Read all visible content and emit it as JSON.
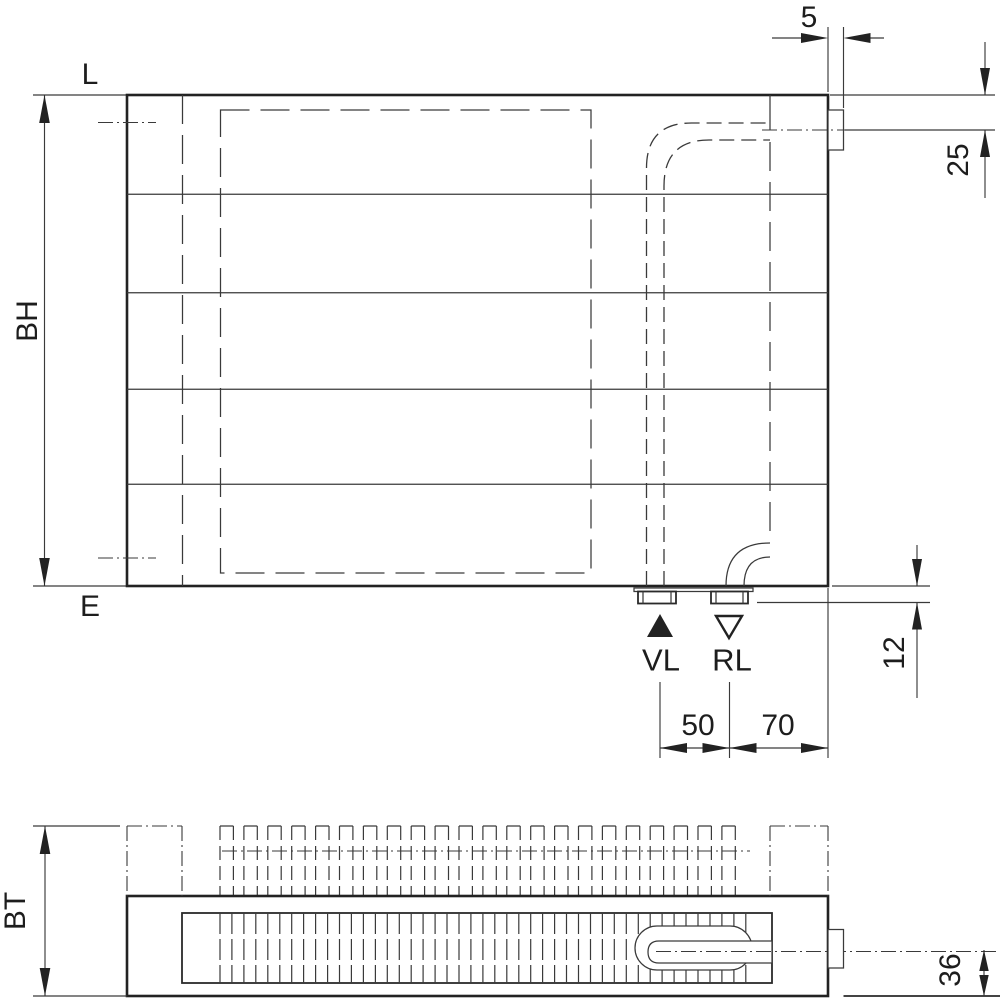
{
  "drawing": {
    "front_view": {
      "length_label": "L",
      "build_height_label": "BH",
      "bottom_edge_label": "E",
      "supply_label": "VL",
      "return_label": "RL",
      "dim_bracket_offset": "5",
      "dim_top_connection_center": "25",
      "dim_connection_protrusion": "12",
      "dim_supply_return_spacing": "50",
      "dim_return_to_edge": "70"
    },
    "top_view": {
      "build_depth_label": "BT",
      "dim_outlet_center": "36"
    },
    "colors": {
      "line": "#222222",
      "background": "#ffffff"
    }
  }
}
